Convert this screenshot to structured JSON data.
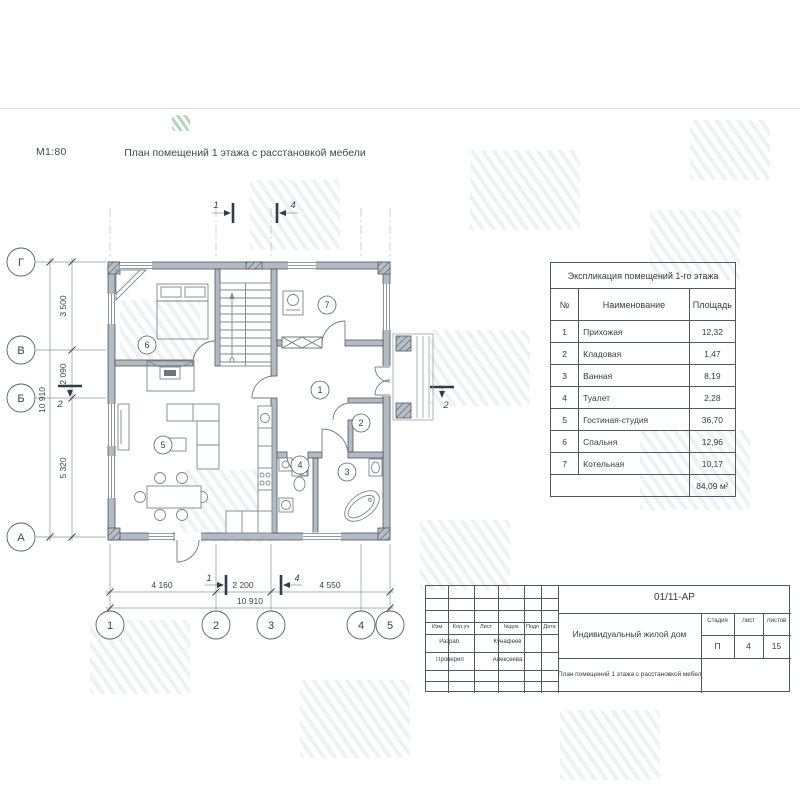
{
  "page": {
    "scale_label": "М1:80",
    "drawing_title": "План помещений 1 этажа с расстановкой мебели"
  },
  "plan": {
    "rooms": [
      "1",
      "2",
      "3",
      "4",
      "5",
      "6",
      "7"
    ],
    "axes_bottom": [
      "1",
      "2",
      "3",
      "4",
      "5"
    ],
    "axes_left": [
      "Г",
      "В",
      "Б",
      "А"
    ],
    "dims_left": [
      "3 500",
      "2 090",
      "5 320"
    ],
    "dims_left_total": "10 910",
    "dims_bottom": [
      "4 160",
      "2 200",
      "4 550"
    ],
    "dims_bottom_total": "10 910",
    "section_labels": {
      "s1": "1",
      "s2": "2",
      "s4": "4"
    }
  },
  "explication": {
    "title": "Экспликация помещений 1-го этажа",
    "columns": {
      "num": "№",
      "name": "Наименование",
      "area": "Площадь"
    },
    "rows": [
      {
        "num": "1",
        "name": "Прихожая",
        "area": "12,32"
      },
      {
        "num": "2",
        "name": "Кладовая",
        "area": "1,47"
      },
      {
        "num": "3",
        "name": "Ванная",
        "area": "8,19"
      },
      {
        "num": "4",
        "name": "Туалет",
        "area": "2,28"
      },
      {
        "num": "5",
        "name": "Гостиная-студия",
        "area": "36,70"
      },
      {
        "num": "6",
        "name": "Спальня",
        "area": "12,96"
      },
      {
        "num": "7",
        "name": "Котельная",
        "area": "10,17"
      }
    ],
    "total_area": "84,09 м²"
  },
  "title_block": {
    "doc_code": "01/11-АР",
    "header_cols": [
      "Изм",
      "Кол.уч",
      "Лист",
      "№док",
      "Подп",
      "Дата"
    ],
    "signature_rows": [
      {
        "role": "Разраб.",
        "name": "Кунафеев"
      },
      {
        "role": "Проверил",
        "name": "Алексеева"
      }
    ],
    "project_name": "Индивидуальный жилой дом",
    "sheet_title": "План помещений 1 этажа с расстановкой мебели",
    "stage_label": "Стадия",
    "sheet_label": "Лист",
    "sheets_label": "Листов",
    "stage": "П",
    "sheet_number": "4",
    "sheets_total": "15"
  }
}
